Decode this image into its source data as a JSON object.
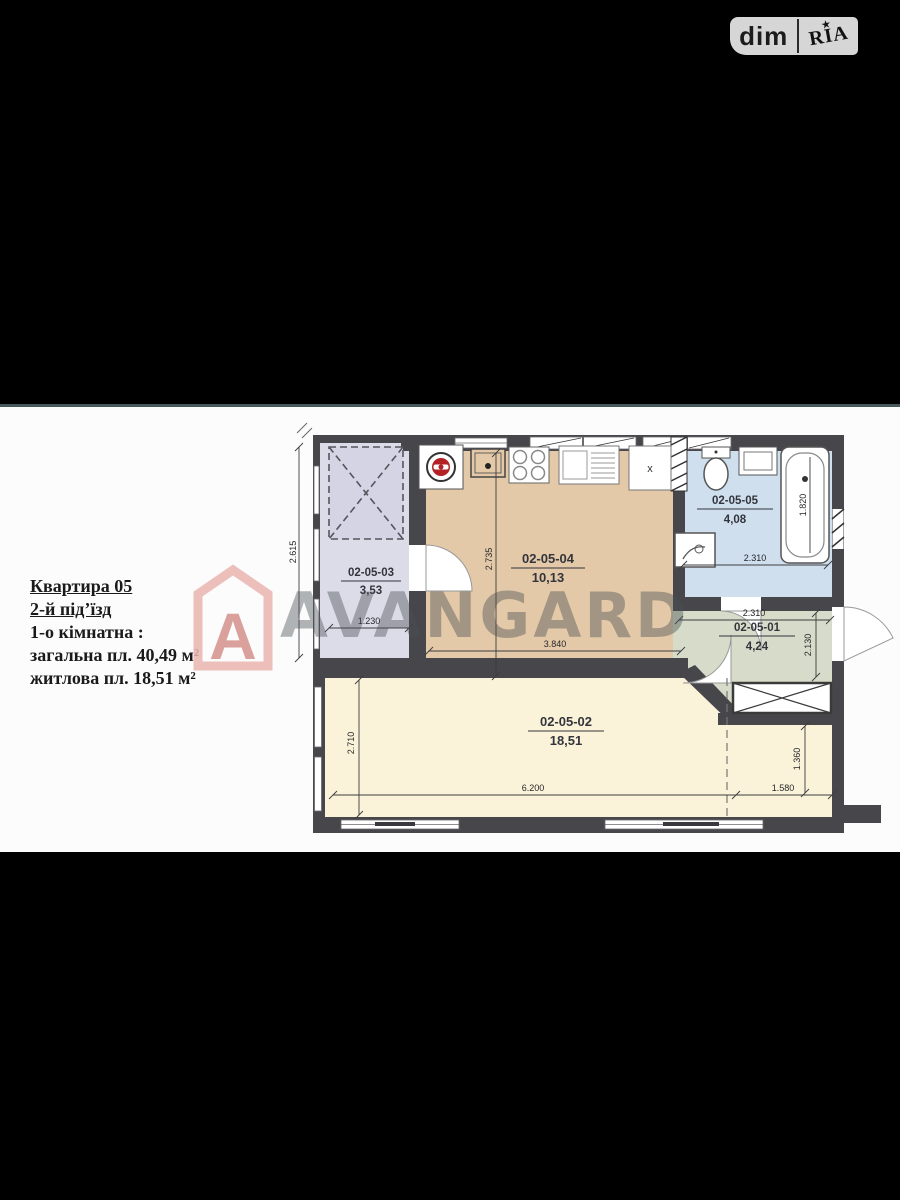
{
  "badge": {
    "dim": "dim",
    "ria": "RIA",
    "star": "★"
  },
  "info": {
    "lines": [
      "Квартира 05",
      "2-й під’їзд",
      "1-о кімнатна :",
      "загальна пл. 40,49 м²",
      "житлова пл. 18,51 м²"
    ]
  },
  "watermark": {
    "text": "AVANGARD",
    "logo_letter": "A"
  },
  "plan": {
    "rooms": [
      {
        "id": "02-05-03",
        "area": "3,53"
      },
      {
        "id": "02-05-04",
        "area": "10,13"
      },
      {
        "id": "02-05-05",
        "area": "4,08"
      },
      {
        "id": "02-05-01",
        "area": "4,24"
      },
      {
        "id": "02-05-02",
        "area": "18,51"
      }
    ],
    "dims": {
      "balcony_height": "2.615",
      "balcony_width": "1.230",
      "kitchen_height": "2.735",
      "kitchen_width": "3.840",
      "tub_length": "1.820",
      "bath_width": "2.310",
      "hall_width": "2.310",
      "hall_height": "2.130",
      "living_height": "2.710",
      "living_width": "6.200",
      "niche_width": "1.580",
      "niche_height": "1.360"
    },
    "fridge_mark": "x"
  },
  "colors": {
    "wall": "#47474b",
    "balcony_fill": "#dcdce8",
    "kitchen_fill": "#e3c9a8",
    "bath_fill": "#cfdfee",
    "hall_fill": "#d6dcc9",
    "living_fill": "#faf3d9",
    "boiler_red": "#b32025",
    "watermark_pink": "#e8aaa6"
  }
}
